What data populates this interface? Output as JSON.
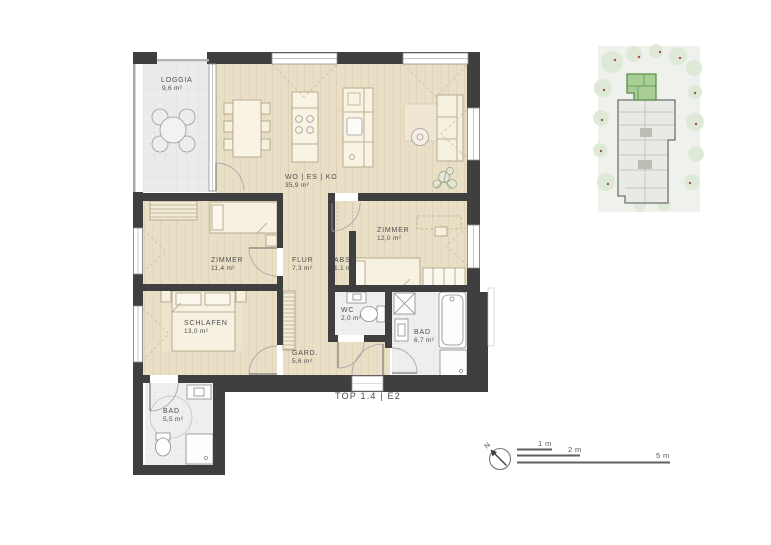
{
  "plan": {
    "title": "TOP 1.4 | E2",
    "rooms": [
      {
        "id": "loggia",
        "name": "LOGGIA",
        "area": "9,6 m²"
      },
      {
        "id": "wohnen",
        "name": "WO | ES | KO",
        "area": "35,9 m²"
      },
      {
        "id": "zimmer1",
        "name": "ZIMMER",
        "area": "11,4 m²"
      },
      {
        "id": "flur",
        "name": "FLUR",
        "area": "7,3 m²"
      },
      {
        "id": "abstell",
        "name": "ABST.",
        "area": "1,1 m²"
      },
      {
        "id": "zimmer2",
        "name": "ZIMMER",
        "area": "12,0 m²"
      },
      {
        "id": "schlafen",
        "name": "SCHLAFEN",
        "area": "13,0 m²"
      },
      {
        "id": "wc",
        "name": "WC",
        "area": "2,0 m²"
      },
      {
        "id": "garderobe",
        "name": "GARD.",
        "area": "5,6 m²"
      },
      {
        "id": "bad1",
        "name": "BAD",
        "area": "6,7 m²"
      },
      {
        "id": "bad2",
        "name": "BAD",
        "area": "5,5 m²"
      }
    ],
    "colors": {
      "wall": "#3f3f3f",
      "wood_floor": "#e9dfc7",
      "tile_floor": "#ededed",
      "site_unit_highlight": "#a9ce95"
    }
  },
  "scale_bar": {
    "labels": [
      "1 m",
      "2 m",
      "5 m"
    ]
  },
  "compass": {
    "north_label": "N"
  }
}
